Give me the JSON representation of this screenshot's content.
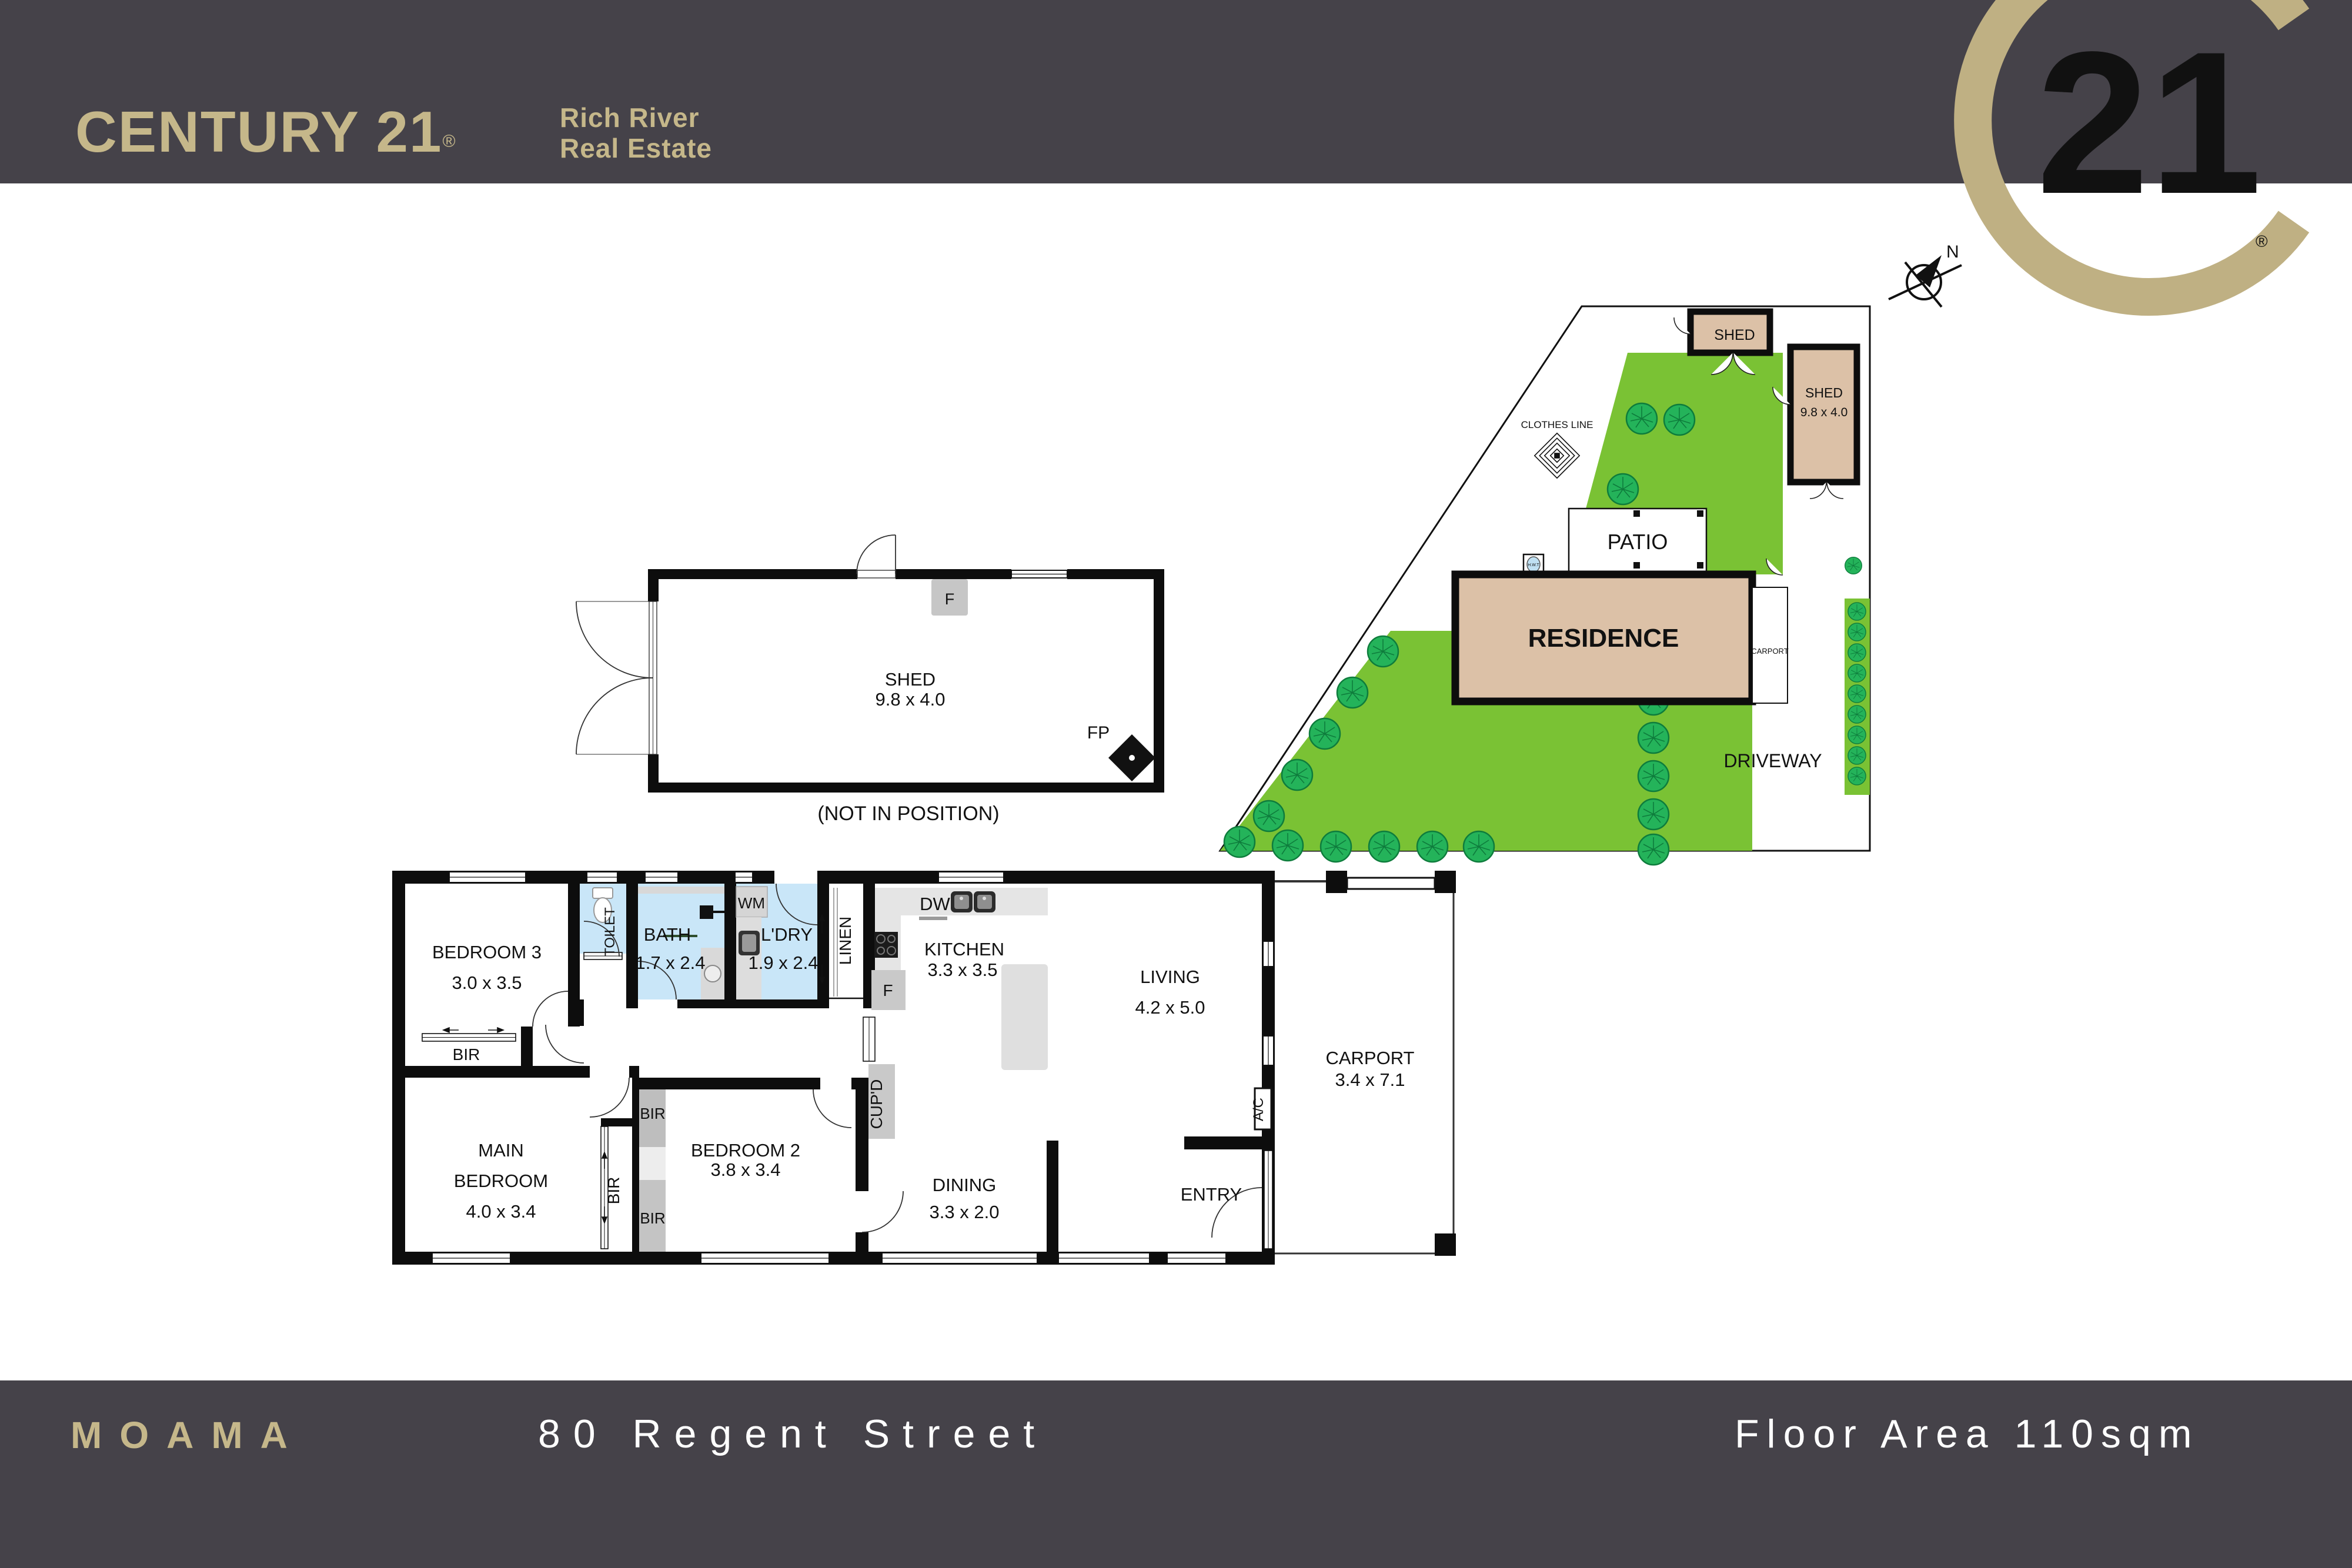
{
  "header": {
    "brand": "CENTURY 21",
    "registered": "®",
    "office_line1": "Rich River",
    "office_line2": "Real Estate",
    "seal_number": "21",
    "seal_registered": "®"
  },
  "footer": {
    "suburb": "MOAMA",
    "address": "80 Regent Street",
    "floor_area": "Floor Area 110sqm"
  },
  "compass": {
    "north": "N"
  },
  "site_plan": {
    "shed_small": "SHED",
    "shed_large_name": "SHED",
    "shed_large_dims": "9.8 x 4.0",
    "clothes_line": "CLOTHES LINE",
    "hwt": "H.W.T",
    "patio": "PATIO",
    "residence": "RESIDENCE",
    "carport": "CARPORT",
    "driveway": "DRIVEWAY"
  },
  "shed_plan": {
    "name": "SHED",
    "dims": "9.8 x 4.0",
    "fridge": "F",
    "fireplace": "FP",
    "note": "(NOT IN POSITION)"
  },
  "floor_plan": {
    "bedroom3": {
      "name": "BEDROOM 3",
      "dims": "3.0 x 3.5"
    },
    "toilet": "TOILET",
    "bath": {
      "name": "BATH",
      "dims": "1.7 x 2.4"
    },
    "wm": "WM",
    "ldry": {
      "name": "L'DRY",
      "dims": "1.9 x 2.4"
    },
    "linen": "LINEN",
    "kitchen": {
      "name": "KITCHEN",
      "dims": "3.3 x 3.5"
    },
    "dw": "DW",
    "fridge": "F",
    "living": {
      "name": "LIVING",
      "dims": "4.2 x 5.0"
    },
    "cupd": "CUP'D",
    "ac": "A/C",
    "bir": "BIR",
    "main_bedroom": {
      "line1": "MAIN",
      "line2": "BEDROOM",
      "dims": "4.0 x 3.4"
    },
    "bedroom2": {
      "name": "BEDROOM 2",
      "dims": "3.8 x 3.4"
    },
    "dining": {
      "name": "DINING",
      "dims": "3.3 x 2.0"
    },
    "entry": "ENTRY",
    "carport": {
      "name": "CARPORT",
      "dims": "3.4 x 7.1"
    }
  },
  "colors": {
    "header_bg": "#454249",
    "gold": "#C5B78A",
    "seal_gold": "#BFB083",
    "wall": "#111111",
    "building_tan": "#DCC1A7",
    "lawn_green": "#7AC234",
    "tree_green": "#24B35A",
    "wet_area_blue": "#C9E6F8",
    "bench_gray": "#E3E3E3",
    "fixture_gray": "#C6C6C6"
  }
}
